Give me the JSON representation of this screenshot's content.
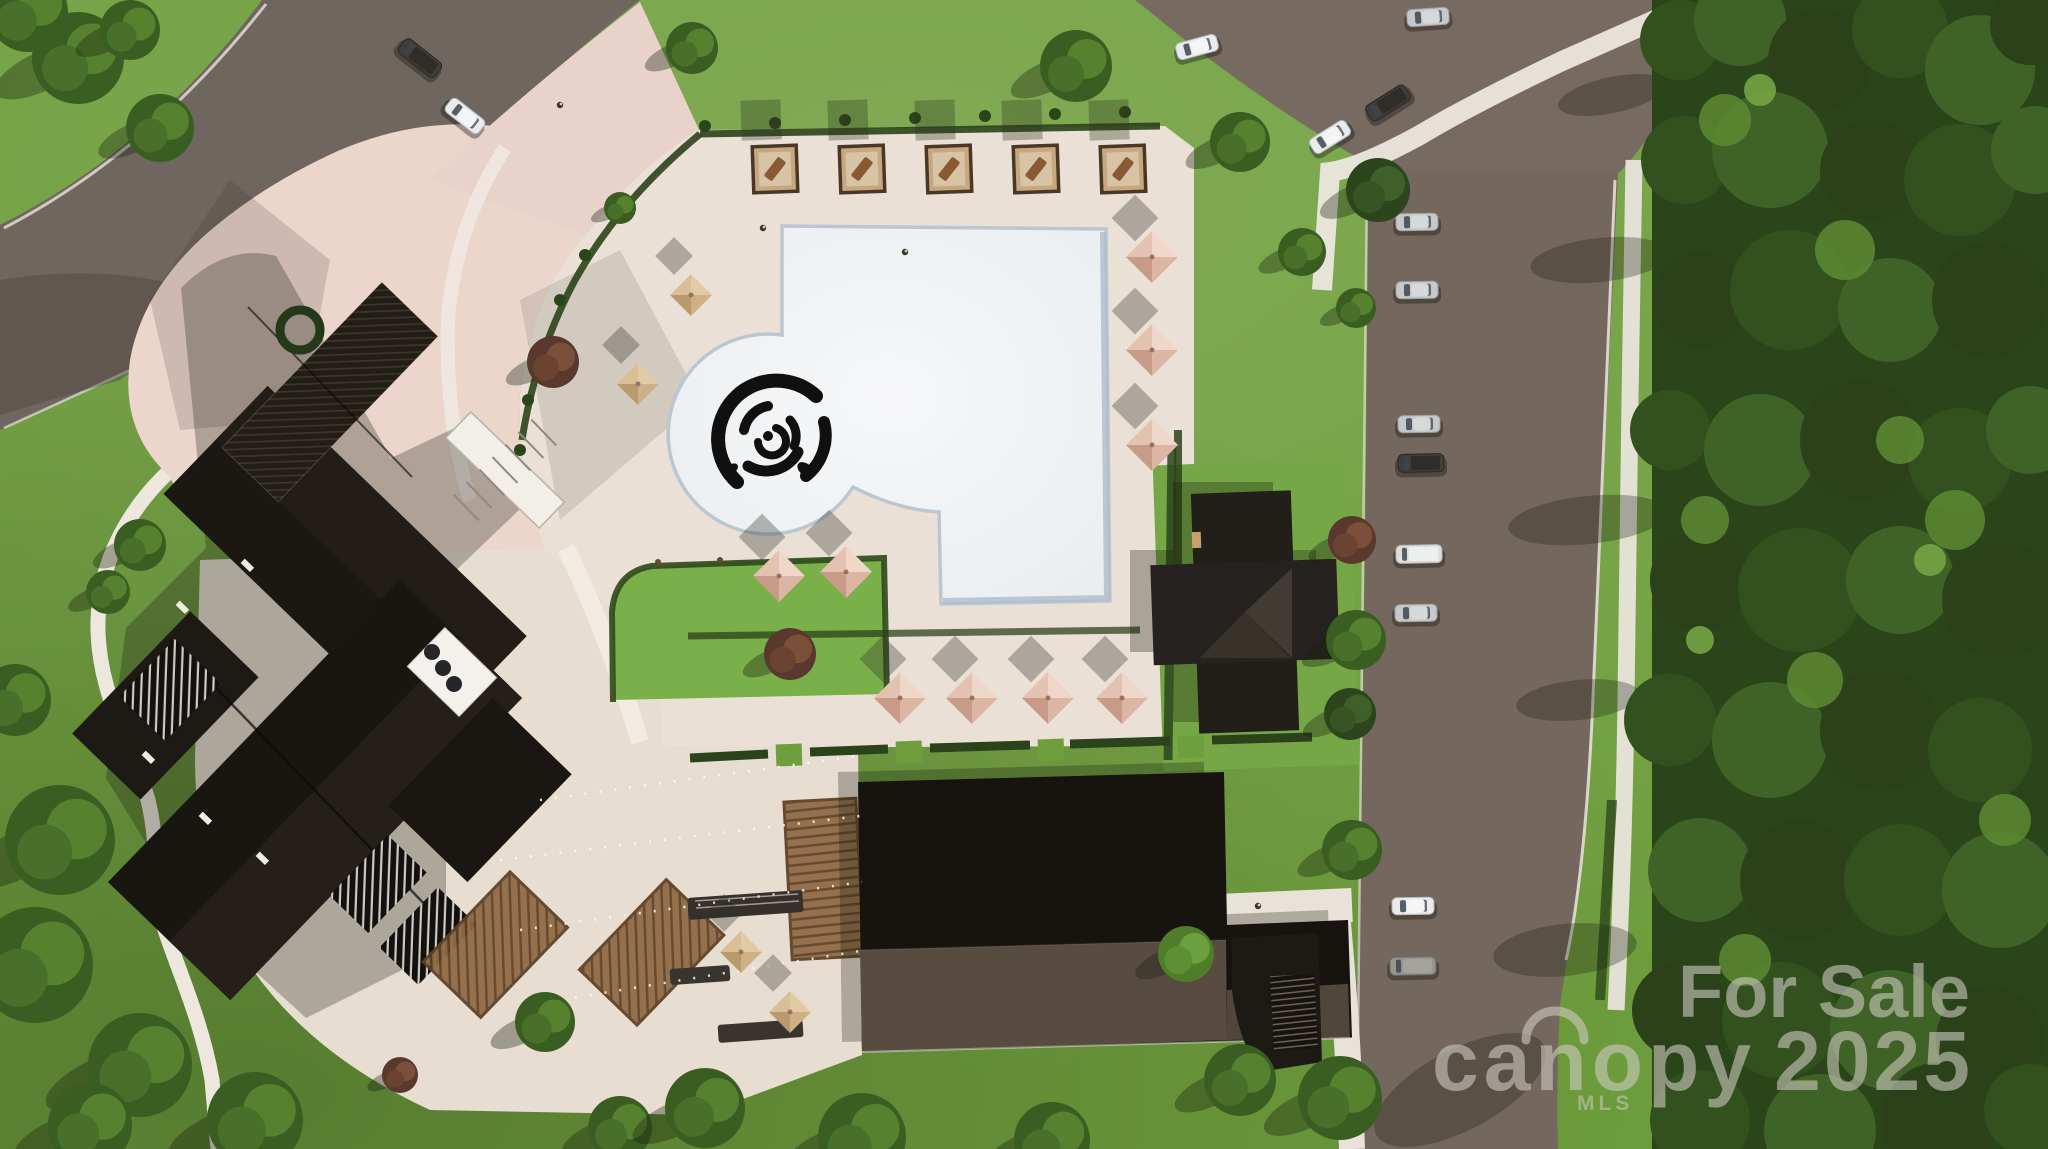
{
  "title": "Aerial site rendering - clubhouse amenity campus for sale",
  "watermark": {
    "for_sale": "For Sale",
    "brand": "canopy",
    "year": "2025",
    "mls": "MLS",
    "color": "rgba(206,201,193,0.60)"
  },
  "palette": {
    "grass": "#6f9f3d",
    "lawn": "#7ab04a",
    "forest_base": "#2b451b",
    "road": "#6f6660",
    "asphalt": "#7a6c63",
    "deck_cream": "#eae0d5",
    "plaza_pink": "#ecd6cc",
    "pool_white": "#f3f4f5",
    "pool_rim": "#bac6d1",
    "roof_dark": "#1a1612",
    "roof_gray": "#584c40",
    "umbrella_pink": "#dcb5a4",
    "umbrella_tan": "#cdb086",
    "pergola_brown": "#8f6b44",
    "sidewalk": "#e9e4dc",
    "rose": "#101010"
  },
  "scene": {
    "cabanas": {
      "count": 5,
      "size": [
        44,
        46
      ],
      "positions": [
        [
          753,
          146
        ],
        [
          840,
          146
        ],
        [
          927,
          146
        ],
        [
          1014,
          146
        ],
        [
          1101,
          146
        ]
      ]
    },
    "umbrellas_pink": [
      [
        1152,
        257
      ],
      [
        1152,
        350
      ],
      [
        1152,
        445
      ],
      [
        900,
        698
      ],
      [
        972,
        698
      ],
      [
        1048,
        698
      ],
      [
        1122,
        698
      ],
      [
        779,
        576
      ],
      [
        846,
        572
      ]
    ],
    "umbrellas_tan": [
      [
        691,
        295
      ],
      [
        638,
        384
      ],
      [
        741,
        952
      ],
      [
        790,
        1012
      ]
    ],
    "cypress": [
      [
        705,
        126
      ],
      [
        775,
        123
      ],
      [
        845,
        120
      ],
      [
        915,
        118
      ],
      [
        985,
        116
      ],
      [
        1055,
        114
      ],
      [
        1125,
        112
      ],
      [
        585,
        255
      ],
      [
        560,
        300
      ],
      [
        540,
        350
      ],
      [
        528,
        400
      ],
      [
        520,
        450
      ]
    ],
    "cars": [
      {
        "x": 1197,
        "y": 47,
        "rot": -15,
        "type": "sedan-white"
      },
      {
        "x": 1330,
        "y": 137,
        "rot": -32,
        "type": "sedan-white"
      },
      {
        "x": 1388,
        "y": 103,
        "rot": -32,
        "type": "van-dark"
      },
      {
        "x": 1428,
        "y": 17,
        "rot": -4,
        "type": "sedan-silver"
      },
      {
        "x": 420,
        "y": 58,
        "rot": 38,
        "type": "van-dark"
      },
      {
        "x": 465,
        "y": 116,
        "rot": 38,
        "type": "sedan-white"
      },
      {
        "x": 1417,
        "y": 222,
        "rot": -1,
        "type": "sedan-silver"
      },
      {
        "x": 1417,
        "y": 290,
        "rot": -1,
        "type": "sedan-silver"
      },
      {
        "x": 1419,
        "y": 424,
        "rot": -1,
        "type": "sedan-silver"
      },
      {
        "x": 1421,
        "y": 463,
        "rot": -1,
        "type": "van-dark"
      },
      {
        "x": 1419,
        "y": 554,
        "rot": -1,
        "type": "van-white"
      },
      {
        "x": 1416,
        "y": 613,
        "rot": -1,
        "type": "sedan-silver"
      },
      {
        "x": 1413,
        "y": 906,
        "rot": -1,
        "type": "sedan-white"
      },
      {
        "x": 1413,
        "y": 966,
        "rot": -1,
        "type": "van-gray"
      }
    ],
    "trees": [
      [
        78,
        58,
        46,
        "g"
      ],
      [
        160,
        128,
        34,
        "g"
      ],
      [
        28,
        12,
        40,
        "g"
      ],
      [
        130,
        30,
        30,
        "g"
      ],
      [
        692,
        48,
        26,
        "g"
      ],
      [
        1076,
        66,
        36,
        "g"
      ],
      [
        1240,
        142,
        30,
        "g"
      ],
      [
        1378,
        190,
        32,
        "d"
      ],
      [
        1302,
        252,
        24,
        "g"
      ],
      [
        1356,
        308,
        20,
        "g"
      ],
      [
        1352,
        540,
        24,
        "r"
      ],
      [
        1356,
        640,
        30,
        "g"
      ],
      [
        1350,
        714,
        26,
        "d"
      ],
      [
        1352,
        850,
        30,
        "g"
      ],
      [
        1340,
        1098,
        42,
        "g"
      ],
      [
        1240,
        1080,
        36,
        "g"
      ],
      [
        1186,
        954,
        28,
        "l"
      ],
      [
        140,
        545,
        26,
        "g"
      ],
      [
        108,
        592,
        22,
        "g"
      ],
      [
        553,
        362,
        26,
        "r"
      ],
      [
        620,
        208,
        16,
        "g"
      ],
      [
        790,
        654,
        26,
        "r"
      ],
      [
        400,
        1075,
        18,
        "r"
      ],
      [
        15,
        700,
        36,
        "g"
      ],
      [
        60,
        840,
        55,
        "g"
      ],
      [
        35,
        965,
        58,
        "g"
      ],
      [
        140,
        1065,
        52,
        "g"
      ],
      [
        255,
        1120,
        48,
        "g"
      ],
      [
        90,
        1125,
        42,
        "g"
      ],
      [
        545,
        1022,
        30,
        "g"
      ],
      [
        620,
        1128,
        32,
        "g"
      ],
      [
        705,
        1108,
        40,
        "g"
      ],
      [
        862,
        1137,
        44,
        "g"
      ],
      [
        1052,
        1140,
        38,
        "g"
      ],
      [
        1692,
        30,
        32,
        "f"
      ],
      [
        1718,
        74,
        34,
        "f"
      ]
    ],
    "forest_blobs": [
      [
        1680,
        40,
        40
      ],
      [
        1740,
        20,
        46
      ],
      [
        1820,
        60,
        52
      ],
      [
        1900,
        30,
        48
      ],
      [
        1980,
        70,
        55
      ],
      [
        2030,
        25,
        40
      ],
      [
        1685,
        160,
        44
      ],
      [
        1770,
        150,
        58
      ],
      [
        1870,
        170,
        50
      ],
      [
        1960,
        180,
        56
      ],
      [
        2035,
        150,
        44
      ],
      [
        1700,
        300,
        48
      ],
      [
        1790,
        290,
        60
      ],
      [
        1890,
        310,
        52
      ],
      [
        1990,
        300,
        58
      ],
      [
        1670,
        430,
        40
      ],
      [
        1760,
        450,
        56
      ],
      [
        1860,
        440,
        60
      ],
      [
        1960,
        460,
        52
      ],
      [
        2030,
        430,
        44
      ],
      [
        1700,
        580,
        50
      ],
      [
        1800,
        590,
        62
      ],
      [
        1900,
        580,
        54
      ],
      [
        2000,
        600,
        58
      ],
      [
        1670,
        720,
        46
      ],
      [
        1770,
        740,
        58
      ],
      [
        1880,
        730,
        60
      ],
      [
        1980,
        750,
        52
      ],
      [
        1700,
        870,
        52
      ],
      [
        1800,
        880,
        60
      ],
      [
        1900,
        880,
        56
      ],
      [
        2000,
        890,
        58
      ],
      [
        1680,
        1010,
        48
      ],
      [
        1780,
        1020,
        58
      ],
      [
        1890,
        1030,
        60
      ],
      [
        1990,
        1040,
        54
      ],
      [
        1700,
        1120,
        50
      ],
      [
        1820,
        1130,
        56
      ],
      [
        1940,
        1120,
        58
      ],
      [
        2030,
        1110,
        46
      ]
    ],
    "forest_clumps": [
      [
        1725,
        120,
        26
      ],
      [
        1845,
        250,
        30
      ],
      [
        1705,
        520,
        24
      ],
      [
        1815,
        680,
        28
      ],
      [
        1745,
        960,
        26
      ],
      [
        1955,
        520,
        30
      ],
      [
        2005,
        820,
        26
      ],
      [
        1900,
        440,
        24
      ]
    ],
    "forest_bright": [
      [
        1760,
        90,
        16
      ],
      [
        1700,
        640,
        14
      ],
      [
        1930,
        560,
        16
      ]
    ],
    "forest_shadows": [
      [
        1600,
        260,
        70,
        22,
        -6
      ],
      [
        1588,
        520,
        80,
        24,
        -6
      ],
      [
        1578,
        700,
        62,
        20,
        -6
      ],
      [
        1565,
        950,
        72,
        26,
        -6
      ],
      [
        1612,
        95,
        55,
        18,
        -12
      ],
      [
        1460,
        1090,
        95,
        40,
        -28
      ]
    ],
    "string_lights": [
      [
        540,
        800,
        858,
        756
      ],
      [
        500,
        860,
        860,
        816
      ],
      [
        520,
        930,
        862,
        882
      ],
      [
        560,
        1000,
        866,
        950
      ]
    ],
    "people": [
      [
        560,
        105
      ],
      [
        763,
        228
      ],
      [
        1258,
        906
      ],
      [
        905,
        252
      ]
    ]
  }
}
